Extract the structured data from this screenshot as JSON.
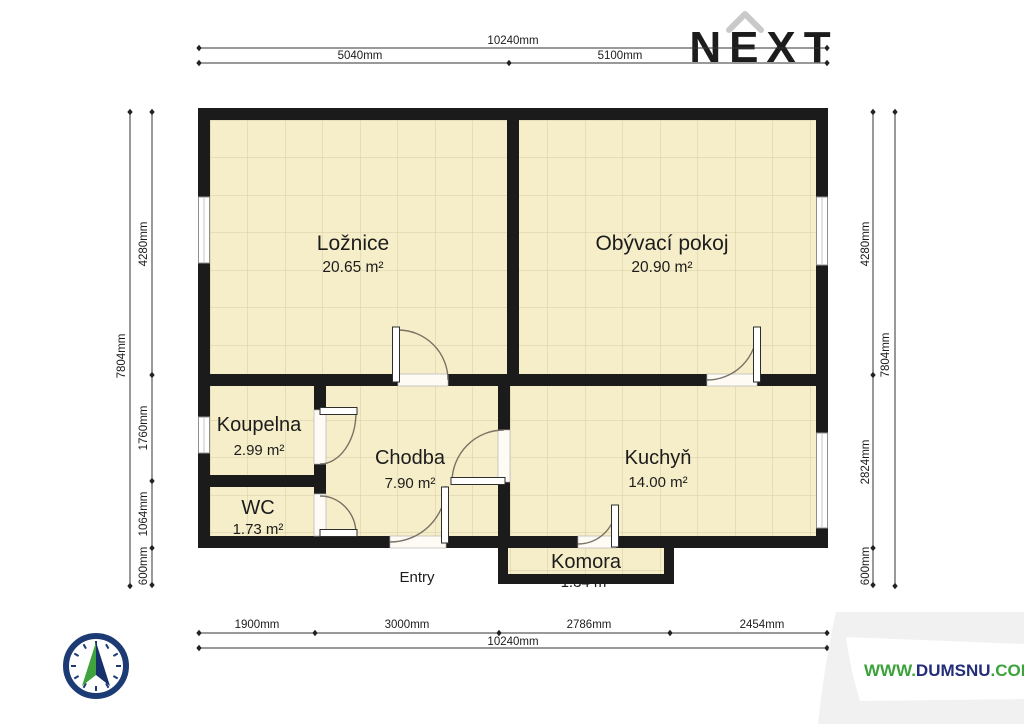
{
  "watermark": {
    "brand": "NEXT"
  },
  "site": {
    "www": "WWW.",
    "name": "DUMSNU",
    "tld": ".COM"
  },
  "entry_label": "Entry",
  "rooms": [
    {
      "name": "Ložnice",
      "area": "20.65 m²"
    },
    {
      "name": "Obývací pokoj",
      "area": "20.90 m²"
    },
    {
      "name": "Koupelna",
      "area": "2.99 m²"
    },
    {
      "name": "Chodba",
      "area": "7.90 m²"
    },
    {
      "name": "WC",
      "area": "1.73 m²"
    },
    {
      "name": "Kuchyň",
      "area": "14.00 m²"
    },
    {
      "name": "Komora",
      "area": "1.34 m²"
    }
  ],
  "dims": {
    "top": {
      "total": "10240mm",
      "seg": [
        "5040mm",
        "5100mm"
      ]
    },
    "bottom": {
      "total": "10240mm",
      "seg": [
        "1900mm",
        "3000mm",
        "2786mm",
        "2454mm"
      ]
    },
    "left": {
      "total": "7804mm",
      "seg": [
        "4280mm",
        "1760mm",
        "1064mm",
        "600mm"
      ]
    },
    "right": {
      "total": "7804mm",
      "seg": [
        "4280mm",
        "2824mm",
        "600mm"
      ]
    }
  },
  "colors": {
    "floor": "#f6eec9",
    "floor_grid": "#d5cba6",
    "wall": "#1b1b1b",
    "brand_gray": "#c9c9c9",
    "compass_navy": "#1c3a73",
    "compass_green": "#3fa23f",
    "site_green": "#3aa33a",
    "site_navy": "#232d7a"
  }
}
